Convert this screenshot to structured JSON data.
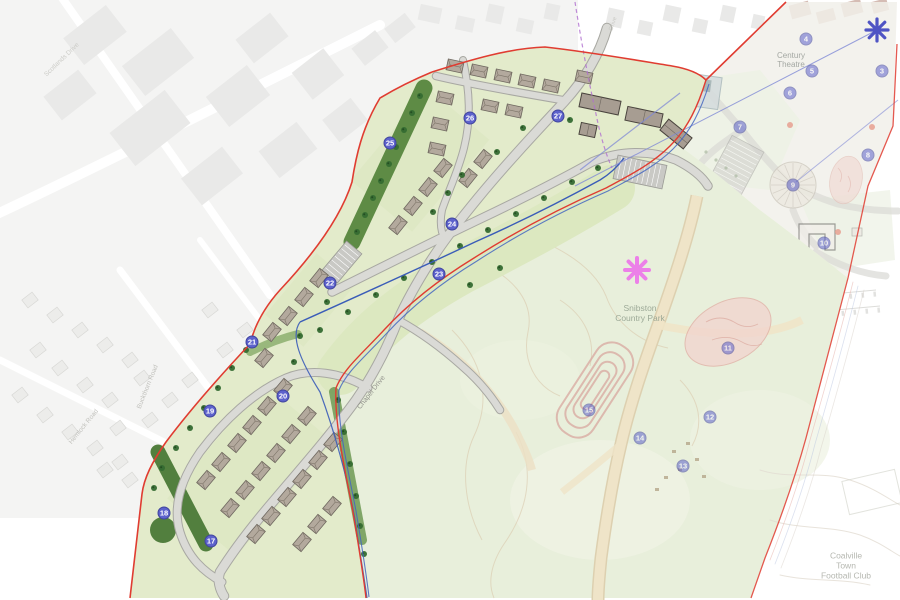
{
  "plan": {
    "type": "residential development site plan with country park",
    "colors": {
      "marker_fill": "#5d62cc",
      "marker_border": "#41459e",
      "boundary_red": "#e03c31",
      "boundary_blue": "#4466c0",
      "asterisk_blue": "#4f54c4",
      "asterisk_pink": "#ec80e8",
      "stream_blue": "#3a5cb8",
      "site_green": "#e3ebcb",
      "buffer_green": "#5e8b45",
      "park_green": "#e8efdb"
    },
    "labels": [
      {
        "id": "century-theatre",
        "text": "Century\nTheatre",
        "x": 791,
        "y": 60,
        "rot": 0,
        "size": 8,
        "color": "#8f948f",
        "opacity": 0.8
      },
      {
        "id": "snibston-country-park",
        "text": "Snibston\nCountry Park",
        "x": 640,
        "y": 314,
        "rot": 0,
        "size": 8.5,
        "color": "#95a391",
        "opacity": 0.9
      },
      {
        "id": "coalville-town-football-club",
        "text": "Coalville Town\nFootball Club",
        "x": 846,
        "y": 566,
        "rot": 0,
        "size": 8.5,
        "color": "#a9aba3",
        "opacity": 0.85
      },
      {
        "id": "chapel-drive",
        "text": "Chapel Drive",
        "x": 372,
        "y": 393,
        "rot": -52,
        "size": 7,
        "color": "#8f8f89",
        "opacity": 0.95
      },
      {
        "id": "hemlock-road",
        "text": "Hemlock Road",
        "x": 84,
        "y": 427,
        "rot": -51,
        "size": 6.5,
        "color": "#bcbcb7",
        "opacity": 0.9
      },
      {
        "id": "buckthorn-road",
        "text": "Buckthorn Road",
        "x": 148,
        "y": 387,
        "rot": -68,
        "size": 6.5,
        "color": "#bcbcb7",
        "opacity": 0.9
      },
      {
        "id": "scotlands-drive",
        "text": "Scotlands Drive",
        "x": 62,
        "y": 60,
        "rot": -44,
        "size": 6.5,
        "color": "#c6c6c1",
        "opacity": 0.85
      },
      {
        "id": "street-name-top",
        "text": "Drive",
        "x": 614,
        "y": 24,
        "rot": -72,
        "size": 6,
        "color": "#c2c2bd",
        "opacity": 0.8
      }
    ],
    "markers": [
      {
        "n": 3,
        "x": 882,
        "y": 71,
        "faded": true
      },
      {
        "n": 4,
        "x": 806,
        "y": 39,
        "faded": true
      },
      {
        "n": 5,
        "x": 812,
        "y": 71,
        "faded": true
      },
      {
        "n": 6,
        "x": 790,
        "y": 93,
        "faded": true
      },
      {
        "n": 7,
        "x": 740,
        "y": 127,
        "faded": true
      },
      {
        "n": 8,
        "x": 868,
        "y": 155,
        "faded": true
      },
      {
        "n": 9,
        "x": 793,
        "y": 185,
        "faded": true
      },
      {
        "n": 10,
        "x": 824,
        "y": 243,
        "faded": true
      },
      {
        "n": 11,
        "x": 728,
        "y": 348,
        "faded": true
      },
      {
        "n": 12,
        "x": 710,
        "y": 417,
        "faded": true
      },
      {
        "n": 13,
        "x": 683,
        "y": 466,
        "faded": true
      },
      {
        "n": 14,
        "x": 640,
        "y": 438,
        "faded": true
      },
      {
        "n": 15,
        "x": 589,
        "y": 410,
        "faded": true
      },
      {
        "n": 17,
        "x": 211,
        "y": 541,
        "faded": false
      },
      {
        "n": 18,
        "x": 164,
        "y": 513,
        "faded": false
      },
      {
        "n": 19,
        "x": 210,
        "y": 411,
        "faded": false
      },
      {
        "n": 20,
        "x": 283,
        "y": 396,
        "faded": false
      },
      {
        "n": 21,
        "x": 252,
        "y": 342,
        "faded": false
      },
      {
        "n": 22,
        "x": 330,
        "y": 283,
        "faded": false
      },
      {
        "n": 23,
        "x": 439,
        "y": 274,
        "faded": false
      },
      {
        "n": 24,
        "x": 452,
        "y": 224,
        "faded": false
      },
      {
        "n": 25,
        "x": 390,
        "y": 143,
        "faded": false
      },
      {
        "n": 26,
        "x": 470,
        "y": 118,
        "faded": false
      },
      {
        "n": 27,
        "x": 558,
        "y": 116,
        "faded": false
      }
    ]
  }
}
